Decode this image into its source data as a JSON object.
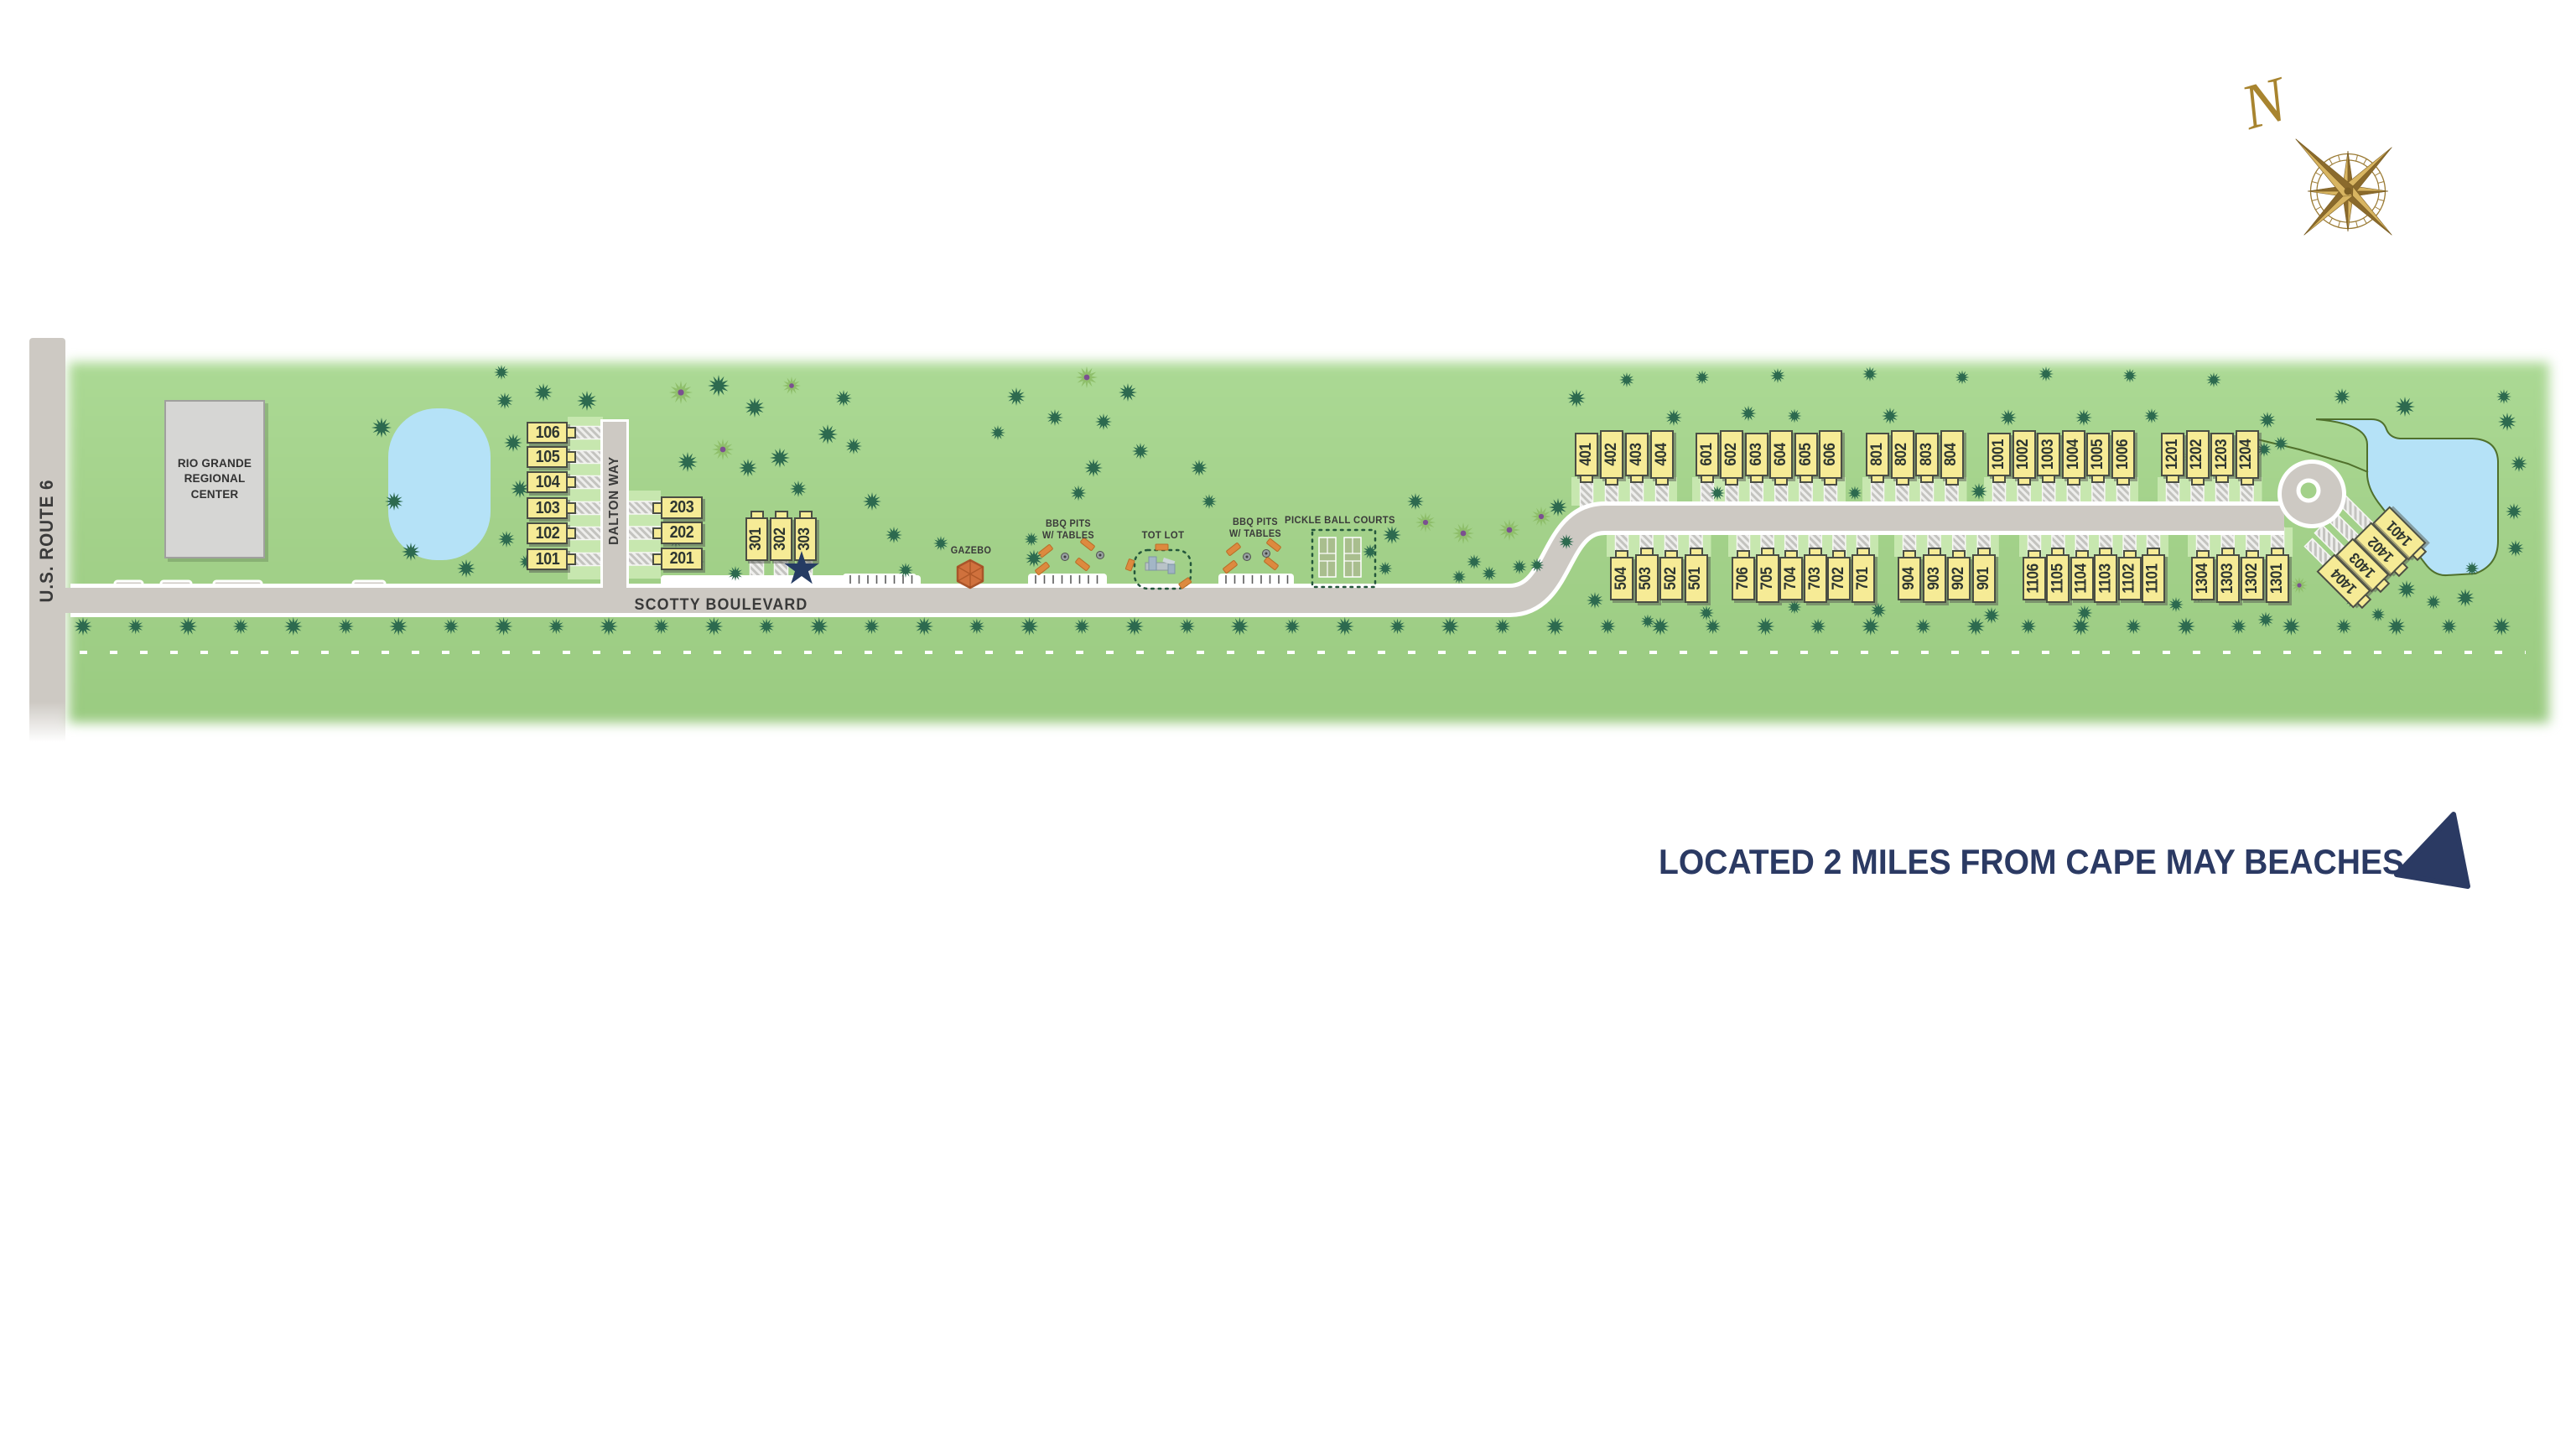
{
  "compass": {
    "north_label": "N"
  },
  "roads": {
    "us_route_6": "U.S. ROUTE 6",
    "scotty": "SCOTTY BOULEVARD",
    "dalton": "DALTON WAY"
  },
  "building": {
    "line1": "RIO GRANDE",
    "line2": "REGIONAL",
    "line3": "CENTER"
  },
  "amenities": {
    "gazebo": "GAZEBO",
    "bbq_pits": {
      "line1": "BBQ PITS",
      "line2": "W/ TABLES"
    },
    "tot_lot": "TOT LOT",
    "pickleball": "PICKLE BALL COURTS"
  },
  "tagline": "LOCATED 2 MILES FROM CAPE MAY BEACHES",
  "lot_groups": {
    "g100": [
      "106",
      "105",
      "104",
      "103",
      "102",
      "101"
    ],
    "g200": [
      "203",
      "202",
      "201"
    ],
    "g300": [
      "301",
      "302",
      "303"
    ],
    "g400": [
      "401",
      "402",
      "403",
      "404"
    ],
    "g500": [
      "504",
      "503",
      "502",
      "501"
    ],
    "g600": [
      "601",
      "602",
      "603",
      "604",
      "605",
      "606"
    ],
    "g700": [
      "706",
      "705",
      "704",
      "703",
      "702",
      "701"
    ],
    "g800": [
      "801",
      "802",
      "803",
      "804"
    ],
    "g900": [
      "904",
      "903",
      "902",
      "901"
    ],
    "g1000": [
      "1001",
      "1002",
      "1003",
      "1004",
      "1005",
      "1006"
    ],
    "g1100": [
      "1106",
      "1105",
      "1104",
      "1103",
      "1102",
      "1101"
    ],
    "g1200": [
      "1201",
      "1202",
      "1203",
      "1204"
    ],
    "g1300": [
      "1304",
      "1303",
      "1302",
      "1301"
    ],
    "g1400": [
      "1401",
      "1402",
      "1403",
      "1404"
    ]
  },
  "colors": {
    "field_green": "#a3d18a",
    "zone_green": "#c7e7af",
    "road_gray": "#cdc9c3",
    "lot_yellow": "#f6eb96",
    "navy": "#2b3a63",
    "pond_blue": "#b5e2f7",
    "compass_gold": "#b08c3c",
    "tree_dark": "#2d6a4f",
    "tree_light": "#8fbf6b"
  }
}
